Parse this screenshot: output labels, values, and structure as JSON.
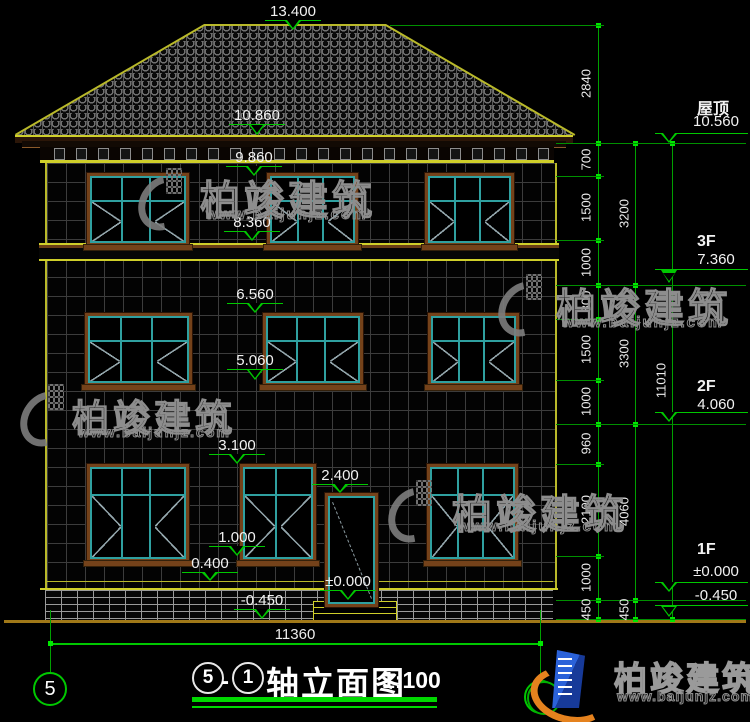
{
  "drawing": {
    "title": {
      "axis_start": "5",
      "separator": "-",
      "axis_end": "1",
      "name": "轴立面图",
      "scale": "1:100"
    },
    "bottom_dim": "11360",
    "axis_bubble_left": "5",
    "axis_bubble_right": "1",
    "left_markers": [
      "13.400",
      "10.860",
      "9.860",
      "8.360",
      "6.560",
      "5.060",
      "3.100",
      "2.400",
      "1.000",
      "0.400",
      "±0.000",
      "-0.450"
    ],
    "right_floor_markers": [
      {
        "label": "屋顶",
        "value": "10.560"
      },
      {
        "label": "3F",
        "value": "7.360"
      },
      {
        "label": "2F",
        "value": "4.060"
      },
      {
        "label": "1F",
        "value": "±0.000"
      },
      {
        "label": "",
        "value": "-0.450"
      }
    ],
    "right_dims_inner": [
      "2840",
      "700",
      "1500",
      "1000",
      "800",
      "1500",
      "1000",
      "960",
      "2100",
      "1000",
      "450"
    ],
    "right_dims_mid": [
      "3200",
      "3300",
      "4060",
      "450"
    ],
    "right_dims_outer": [
      "11010"
    ]
  },
  "watermark": {
    "brand": "柏竣建筑",
    "site": "www.baijunjz.com"
  }
}
